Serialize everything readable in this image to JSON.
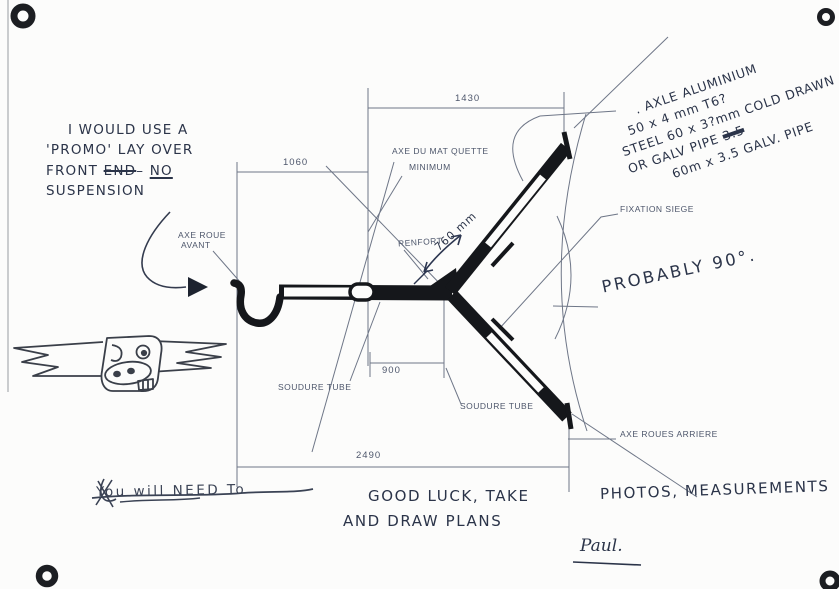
{
  "page": {
    "background": "#fcfcfb",
    "ink_color": "#2b3449",
    "cad_color": "#4d566b",
    "tube_color": "#15171b"
  },
  "dimensions": {
    "top_span": "1430",
    "front_span": "1060",
    "mid_span": "900",
    "overall_span": "2490"
  },
  "labels": {
    "front_axle_line1": "AXE ROUE",
    "front_axle_line2": "AVANT",
    "mast_line1": "AXE DU MAT QUETTE",
    "mast_line2": "MINIMUM",
    "renfort": "RENFORT",
    "seat_fixation": "FIXATION SIEGE",
    "weld_left": "SOUDURE TUBE",
    "weld_right": "SOUDURE TUBE",
    "rear_axle": "AXE ROUES ARRIERE"
  },
  "annotations": {
    "suspension_note": {
      "line1": "I WOULD USE A",
      "line2": "'PROMO' LAY OVER",
      "line3_pre": "FRONT ",
      "line3_struck": "END",
      "line3_mid": "– ",
      "line3_underlined": "NO",
      "line4": "SUSPENSION"
    },
    "axle_note": {
      "line1": ". AXLE ALUMINIUM",
      "line2": "50 x 4 mm T6?",
      "line3": "STEEL 60 x 3?mm COLD DRAWN",
      "line4_pre": "OR GALV PIPE ",
      "line4_struck": "3.5",
      "line5": "60m x 3.5 GALV. PIPE"
    },
    "renfort_value": "760 mm",
    "probably": "PROBABLY 90°.",
    "crossed_out": "You will NEED To",
    "message_part1": "GOOD LUCK, TAKE",
    "message_part2": "PHOTOS, MEASUREMENTS",
    "message_part3": "AND DRAW PLANS",
    "signature": "Paul."
  }
}
